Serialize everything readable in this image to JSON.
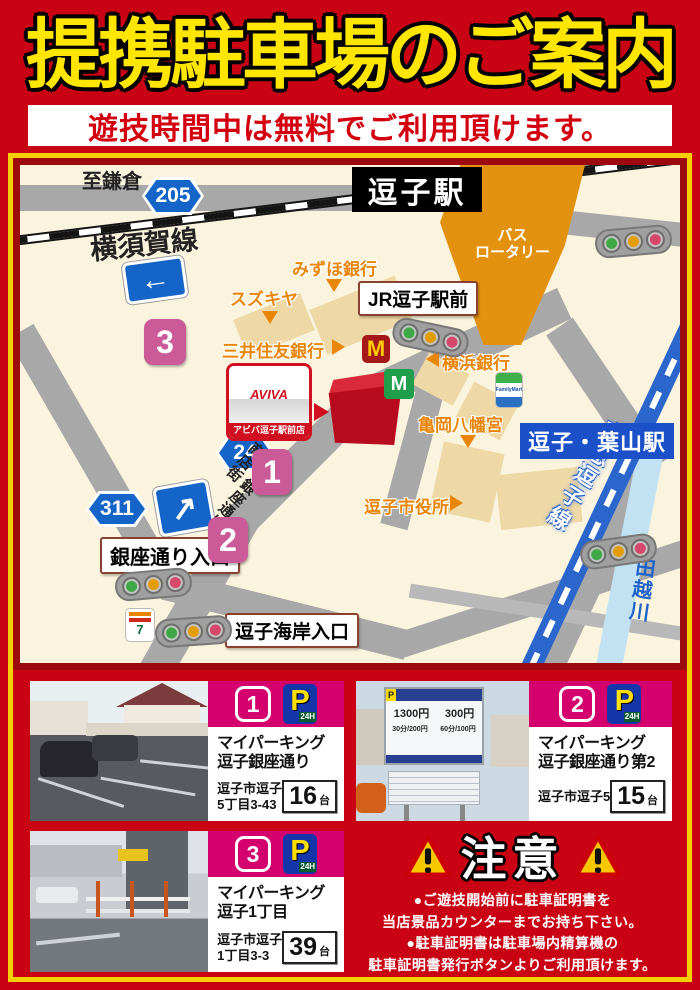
{
  "header": {
    "title": "提携駐車場のご案内",
    "subtitle": "遊技時間中は無料でご利用頂けます。"
  },
  "map": {
    "roads": {
      "to_kamakura": "至鎌倉",
      "route205": "205",
      "route24": "24",
      "route311": "311"
    },
    "rail": {
      "yokosuka": "横須賀線",
      "keikyu": "京急逗子線"
    },
    "river": "田越川",
    "stations": {
      "zushi": "逗子駅",
      "zushi_hayama": "逗子・葉山駅"
    },
    "rotary": {
      "line1": "バス",
      "line2": "ロータリー"
    },
    "labels": {
      "jr_zushi": "JR逗子駅前",
      "ginza_entrance": "銀座通り入口",
      "kaigan_entrance": "逗子海岸入口"
    },
    "landmarks": {
      "mizuho": "みずほ銀行",
      "suzukiya": "スズキヤ",
      "smbc": "三井住友銀行",
      "yokohama_bank": "横浜銀行",
      "kameoka": "亀岡八幡宮",
      "city_hall": "逗子市役所"
    },
    "street": {
      "line1": "逗子銀座通り",
      "line2": "商店街"
    },
    "aviva": {
      "logo": "AVIVA",
      "label": "アビバ逗子駅前店"
    },
    "markers": {
      "m1": "1",
      "m2": "2",
      "m3": "3"
    },
    "brands": {
      "mcdonalds": "M",
      "mos": "M",
      "seven": "7",
      "familymart": "FamilyMart"
    },
    "arrows": {
      "left": "←",
      "upright": "↗"
    }
  },
  "parking_cards": [
    {
      "badge": "1",
      "p": "P",
      "hours": "24H",
      "name1": "マイパーキング",
      "name2": "逗子銀座通り",
      "addr1": "逗子市逗子",
      "addr2": "5丁目3-43",
      "capacity": "16",
      "unit": "台"
    },
    {
      "badge": "2",
      "p": "P",
      "hours": "24H",
      "name1": "マイパーキング",
      "name2": "逗子銀座通り第2",
      "addr1": "逗子市逗子5",
      "addr2": "",
      "capacity": "15",
      "unit": "台"
    },
    {
      "badge": "3",
      "p": "P",
      "hours": "24H",
      "name1": "マイパーキング",
      "name2": "逗子1丁目",
      "addr1": "逗子市逗子",
      "addr2": "1丁目3-3",
      "capacity": "39",
      "unit": "台"
    }
  ],
  "photo_sign": {
    "p": "P",
    "price_day": "1300円",
    "price_night": "300円",
    "rate_day": "30分/200円",
    "rate_night": "60分/100円"
  },
  "notice": {
    "title": "注意",
    "lines": [
      "●ご遊技開始前に駐車証明書を",
      "当店景品カウンターまでお持ち下さい。",
      "●駐車証明書は駐車場内精算機の",
      "駐車証明書発行ボタンよりご利用頂けます。"
    ]
  },
  "colors": {
    "page_red": "#c90313",
    "magenta": "#d4006e",
    "map_cream": "#faf3dd",
    "accent_yellow": "#ffe600"
  }
}
